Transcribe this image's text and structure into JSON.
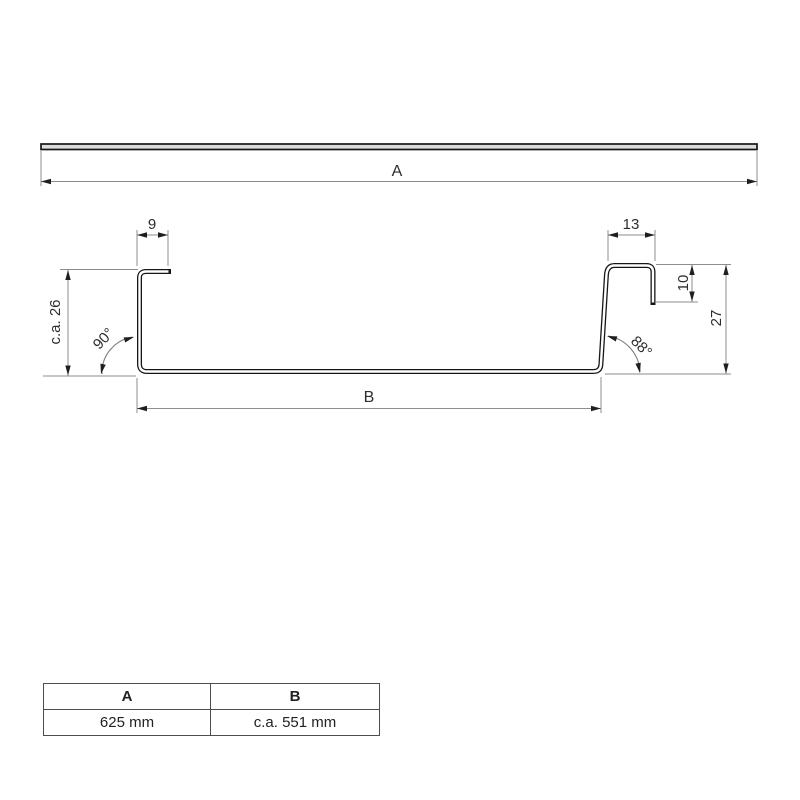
{
  "top_view": {
    "dim_a": "A"
  },
  "cross_section": {
    "dim_flange_left": "9",
    "dim_flange_right": "13",
    "dim_lip_right": "10",
    "dim_height_right": "27",
    "dim_height_left": "c.a. 26",
    "angle_left": "90°",
    "angle_right": "88°",
    "dim_base": "B"
  },
  "table": {
    "headers": [
      "A",
      "B"
    ],
    "values": [
      "625 mm",
      "c.a. 551 mm"
    ]
  },
  "colors": {
    "background": "#ffffff",
    "profile_line": "#161616",
    "dimension_line": "#8d8d8d",
    "arrow": "#1f1f1f",
    "text": "#2d2d2d",
    "bar_fill": "#dcdcdc",
    "table_border": "#4d4d4d"
  }
}
